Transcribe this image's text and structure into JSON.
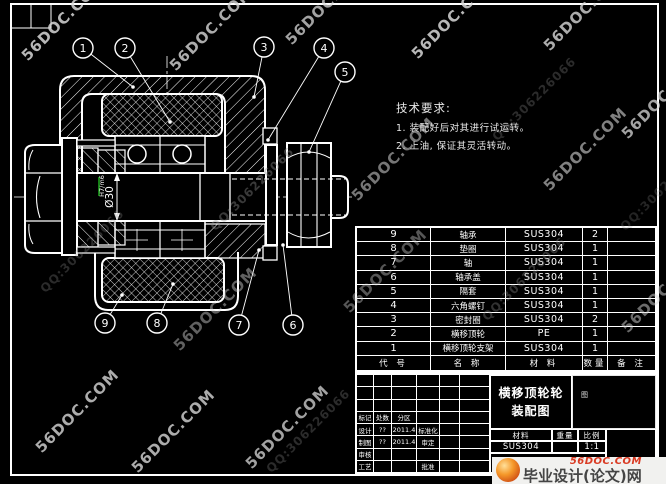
{
  "sheet": {
    "background": "#000000",
    "line_color": "#ffffff",
    "accent_green": "#1faa1f"
  },
  "tech_requirements": {
    "title": "技术要求:",
    "lines": [
      "1. 装配好后对其进行试运转。",
      "2. 上油, 保证其灵活转动。"
    ]
  },
  "dimension": {
    "value": "Ø30",
    "fit": "H7/m6"
  },
  "balloons": [
    {
      "n": "1",
      "cx": 83,
      "cy": 48,
      "ex": 133,
      "ey": 87
    },
    {
      "n": "2",
      "cx": 125,
      "cy": 48,
      "ex": 170,
      "ey": 122
    },
    {
      "n": "3",
      "cx": 264,
      "cy": 47,
      "ex": 254,
      "ey": 97
    },
    {
      "n": "4",
      "cx": 324,
      "cy": 48,
      "ex": 268,
      "ey": 140
    },
    {
      "n": "5",
      "cx": 345,
      "cy": 72,
      "ex": 309,
      "ey": 152
    },
    {
      "n": "9",
      "cx": 105,
      "cy": 323,
      "ex": 122,
      "ey": 295
    },
    {
      "n": "8",
      "cx": 157,
      "cy": 323,
      "ex": 173,
      "ey": 284
    },
    {
      "n": "7",
      "cx": 239,
      "cy": 325,
      "ex": 259,
      "ey": 250
    },
    {
      "n": "6",
      "cx": 293,
      "cy": 325,
      "ex": 283,
      "ey": 245
    }
  ],
  "parts_list": {
    "headers": [
      "代 号",
      "名 称",
      "材 料",
      "数量",
      "备 注"
    ],
    "rows": [
      [
        "9",
        "轴承",
        "SUS304",
        "2",
        ""
      ],
      [
        "8",
        "垫圈",
        "SUS304",
        "1",
        ""
      ],
      [
        "7",
        "轴",
        "SUS304",
        "1",
        ""
      ],
      [
        "6",
        "轴承盖",
        "SUS304",
        "1",
        ""
      ],
      [
        "5",
        "隔套",
        "SUS304",
        "1",
        ""
      ],
      [
        "4",
        "六角螺钉",
        "SUS304",
        "1",
        ""
      ],
      [
        "3",
        "密封圈",
        "SUS304",
        "2",
        ""
      ],
      [
        "2",
        "横移顶轮",
        "PE",
        "1",
        ""
      ],
      [
        "1",
        "横移顶轮支架",
        "SUS304",
        "1",
        ""
      ]
    ]
  },
  "title_block": {
    "left_rows": [
      [
        "",
        "",
        "",
        "",
        "",
        ""
      ],
      [
        "",
        "",
        "",
        "",
        "",
        ""
      ],
      [
        "",
        "",
        "",
        "",
        "",
        ""
      ],
      [
        "标记",
        "处数",
        "分区",
        "",
        "",
        ""
      ],
      [
        "设计",
        "??",
        "2011.4",
        "标准化",
        "",
        ""
      ],
      [
        "制图",
        "??",
        "2011.4",
        "审定",
        "",
        ""
      ],
      [
        "审核",
        "",
        "",
        "",
        "",
        ""
      ],
      [
        "工艺",
        "",
        "",
        "批准",
        "",
        ""
      ]
    ],
    "title_line1": "横移顶轮轮",
    "title_line2": "装配图",
    "material_label": "材料",
    "weight_label": "重量",
    "scale_label": "比例",
    "material_value": "SUS304",
    "weight_value": "",
    "scale_value": "1:1",
    "right_mark": "图"
  },
  "watermarks": {
    "brand": "56DOC.COM",
    "qq": "QQ:306226066",
    "marks": [
      {
        "x": 8,
        "y": 10,
        "t": "b",
        "o": 0.85,
        "s": 15
      },
      {
        "x": 156,
        "y": 20,
        "t": "b",
        "o": 0.8,
        "s": 15
      },
      {
        "x": 272,
        "y": -6,
        "t": "b",
        "o": 0.75,
        "s": 15
      },
      {
        "x": 398,
        "y": 8,
        "t": "b",
        "o": 0.85,
        "s": 15
      },
      {
        "x": 530,
        "y": 0,
        "t": "b",
        "o": 0.8,
        "s": 15
      },
      {
        "x": 608,
        "y": 88,
        "t": "b",
        "o": 0.75,
        "s": 15
      },
      {
        "x": 338,
        "y": 150,
        "t": "b",
        "o": 0.55,
        "s": 15
      },
      {
        "x": 530,
        "y": 140,
        "t": "b",
        "o": 0.6,
        "s": 15
      },
      {
        "x": 160,
        "y": 300,
        "t": "b",
        "o": 0.45,
        "s": 15
      },
      {
        "x": 608,
        "y": 282,
        "t": "b",
        "o": 0.5,
        "s": 15
      },
      {
        "x": 22,
        "y": 402,
        "t": "b",
        "o": 0.8,
        "s": 15
      },
      {
        "x": 118,
        "y": 422,
        "t": "b",
        "o": 0.8,
        "s": 15
      },
      {
        "x": 232,
        "y": 418,
        "t": "b",
        "o": 0.75,
        "s": 15
      },
      {
        "x": 330,
        "y": 262,
        "t": "b",
        "o": 0.4,
        "s": 15
      },
      {
        "x": 196,
        "y": 182,
        "t": "q",
        "o": 0.4,
        "s": 12
      },
      {
        "x": 26,
        "y": 244,
        "t": "q",
        "o": 0.3,
        "s": 12
      },
      {
        "x": 468,
        "y": 272,
        "t": "q",
        "o": 0.35,
        "s": 12
      },
      {
        "x": 252,
        "y": 424,
        "t": "q",
        "o": 0.3,
        "s": 12
      },
      {
        "x": 478,
        "y": 92,
        "t": "q",
        "o": 0.3,
        "s": 12
      },
      {
        "x": 606,
        "y": 182,
        "t": "q",
        "o": 0.25,
        "s": 12
      }
    ]
  },
  "footer_logo": {
    "site": "56DOC.COM",
    "name": "毕业设计(论文)网"
  }
}
